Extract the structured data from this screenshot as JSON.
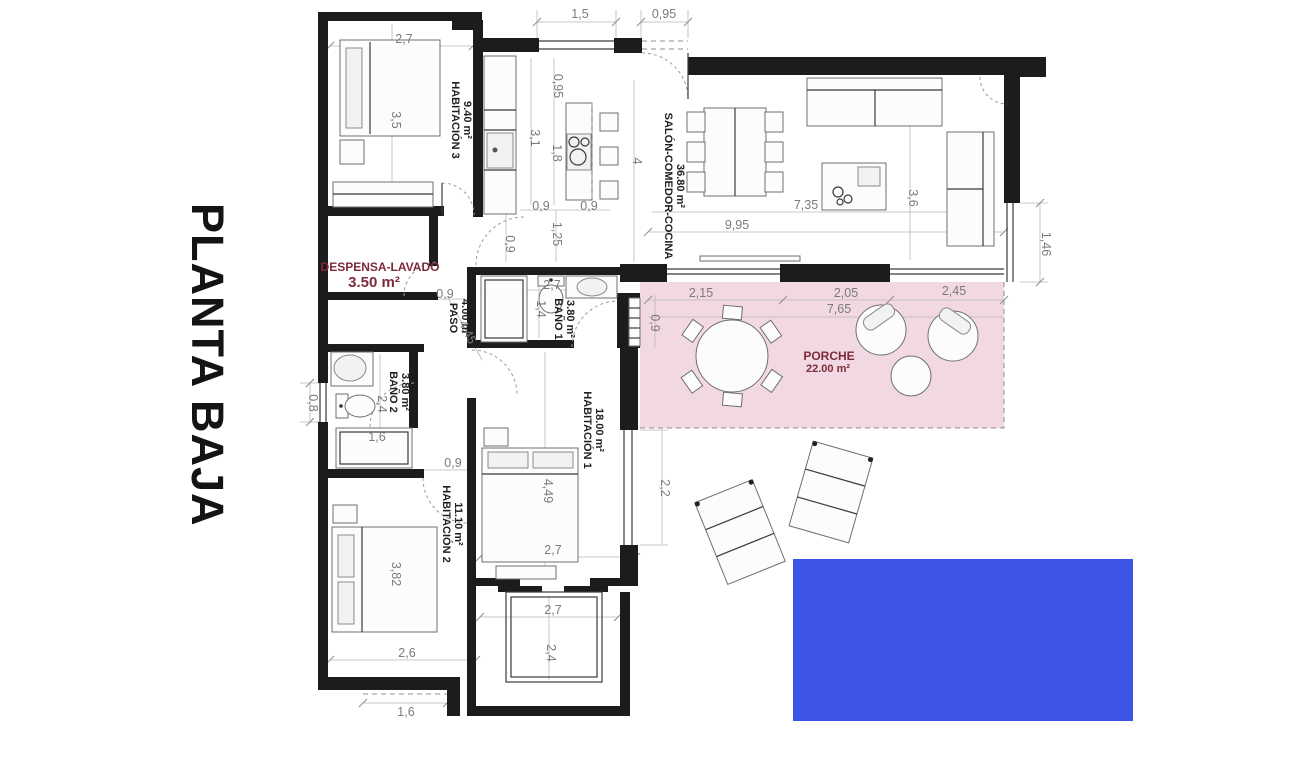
{
  "title": "PLANTA BAJA",
  "colors": {
    "porch_fill": "#F2D8E3",
    "pool_fill": "#3C55E6",
    "accent_text": "#7D2B39",
    "wall": "#1C1C1C",
    "dim_text": "#7B7B7B"
  },
  "rooms": {
    "hab3": {
      "name": "HABITACIÓN 3",
      "area": "9.40 m²"
    },
    "salon": {
      "name": "SALÓN-COMEDOR-COCINA",
      "area": "36.80 m²"
    },
    "despensa": {
      "name": "DESPENSA-LAVADO",
      "area": "3.50 m²"
    },
    "paso": {
      "name": "PASO",
      "area": "4.00 m²"
    },
    "bano1": {
      "name": "BAÑO 1",
      "area": "3.80 m²"
    },
    "bano2": {
      "name": "BAÑO 2",
      "area": "3.80 m²"
    },
    "hab1": {
      "name": "HABITACIÓN 1",
      "area": "18.00 m²"
    },
    "hab2": {
      "name": "HABITACIÓN 2",
      "area": "11.10 m²"
    },
    "porche": {
      "name": "PORCHE",
      "area": "22.00 m²"
    }
  },
  "dims": {
    "hab3_width": "2,7",
    "hab3_depth": "3,5",
    "top_window": "1,5",
    "top_door": "0,95",
    "kitchen_niche": "0,95",
    "kitchen_width": "3,1",
    "island_len": "1,8",
    "salon_width": "4",
    "pass_a": "0,9",
    "pass_b": "0,9",
    "pass_v": "1,25",
    "hall_door": "0,9",
    "salon_len": "9,95",
    "salon_len2": "7,35",
    "salon_depth": "3,6",
    "right_opening": "1,46",
    "porch_a": "2,15",
    "porch_b": "2,05",
    "porch_c": "2,45",
    "porch_len": "7,65",
    "porch_left": "0,9",
    "paso_width": "0,9",
    "paso_len": "4,45",
    "bano1_width": "2,7",
    "bano1_depth": "1,4",
    "bano2_depth": "2,4",
    "bano2_window": "0,8",
    "bano2_shower": "1,6",
    "hab2_door": "0,9",
    "hab2_bed": "3,82",
    "hab2_width": "2,6",
    "hab2_overhang": "1,6",
    "hab1_depth": "4,49",
    "hab1_width": "2,7",
    "hab1_window": "2,2",
    "patio_width": "2,7",
    "patio_depth": "2,4"
  }
}
